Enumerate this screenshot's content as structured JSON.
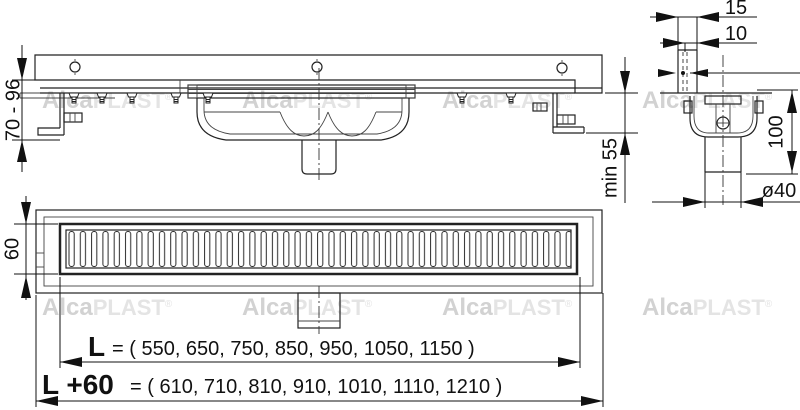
{
  "title": "Drain channel installation drawing",
  "watermark": {
    "bold": "Alca",
    "light": "PLAST",
    "reg": "®"
  },
  "side_view": {
    "height_range": "70 - 96",
    "min_depth": "min 55"
  },
  "section_view": {
    "flange_offset": "15",
    "flange_gap": "10",
    "trap_height": "100",
    "pipe_diameter": "ø40"
  },
  "top_view": {
    "grate_width": "60"
  },
  "lengths": {
    "l_label": "L",
    "l_values_text": "= ( 550, 650, 750, 850, 950, 1050, 1150 )",
    "l_options": [
      550,
      650,
      750,
      850,
      950,
      1050,
      1150
    ],
    "l60_label": "L +60",
    "l60_values_text": "= ( 610, 710, 810, 910, 1010, 1110, 1210 )",
    "l60_options": [
      610,
      710,
      810,
      910,
      1010,
      1110,
      1210
    ]
  },
  "colors": {
    "line": "#222222",
    "dimension": "#111111",
    "watermark_bold": "#d2d2d2",
    "watermark_light": "#e4e4e4",
    "background": "#ffffff"
  }
}
